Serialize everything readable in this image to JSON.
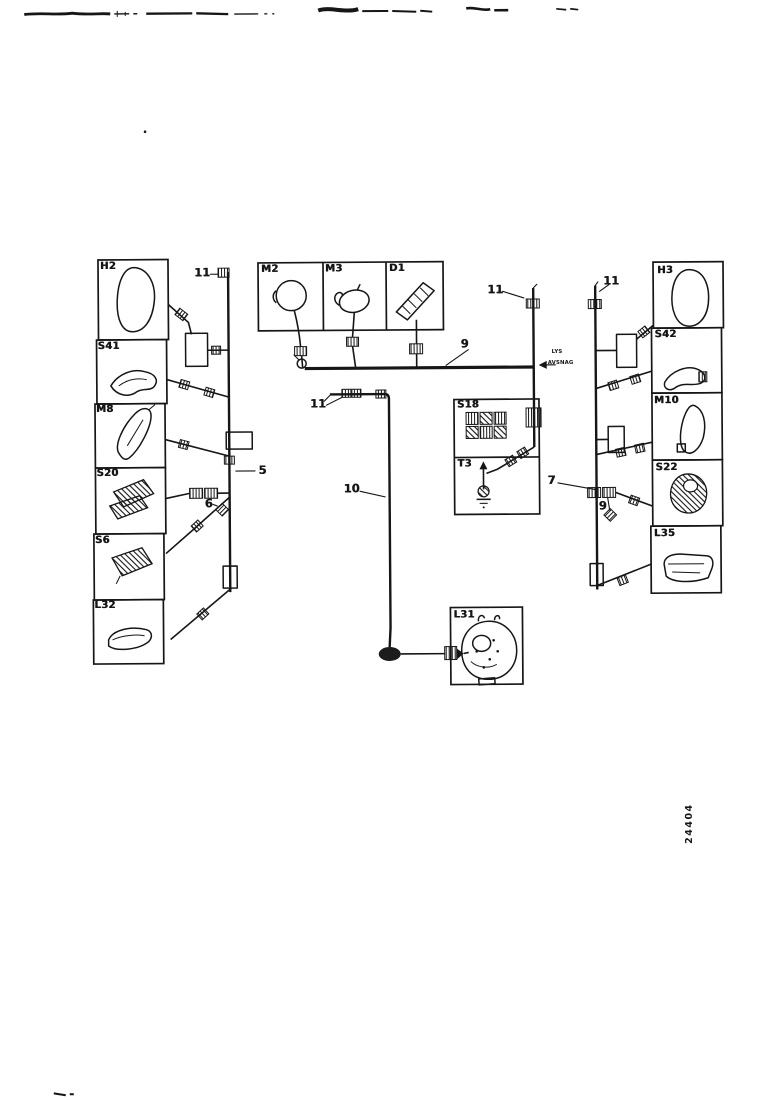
{
  "page": {
    "background": "#ffffff",
    "ink_color": "#161616"
  },
  "figure_number": "24404",
  "note": {
    "line1": "LYS",
    "line2": "AVSNAG"
  },
  "components": {
    "h2": "H2",
    "s41": "S41",
    "m8": "M8",
    "s20": "S20",
    "s6": "S6",
    "l32": "L32",
    "m2": "M2",
    "m3": "M3",
    "d1": "D1",
    "s18": "S18",
    "t3": "T3",
    "l31": "L31",
    "h3": "H3",
    "s42": "S42",
    "m10": "M10",
    "s22": "S22",
    "l35": "L35"
  },
  "wire_callouts": {
    "c5": "5",
    "c6": "6",
    "c7": "7",
    "c9": "9",
    "c10": "10",
    "c11": "11"
  }
}
